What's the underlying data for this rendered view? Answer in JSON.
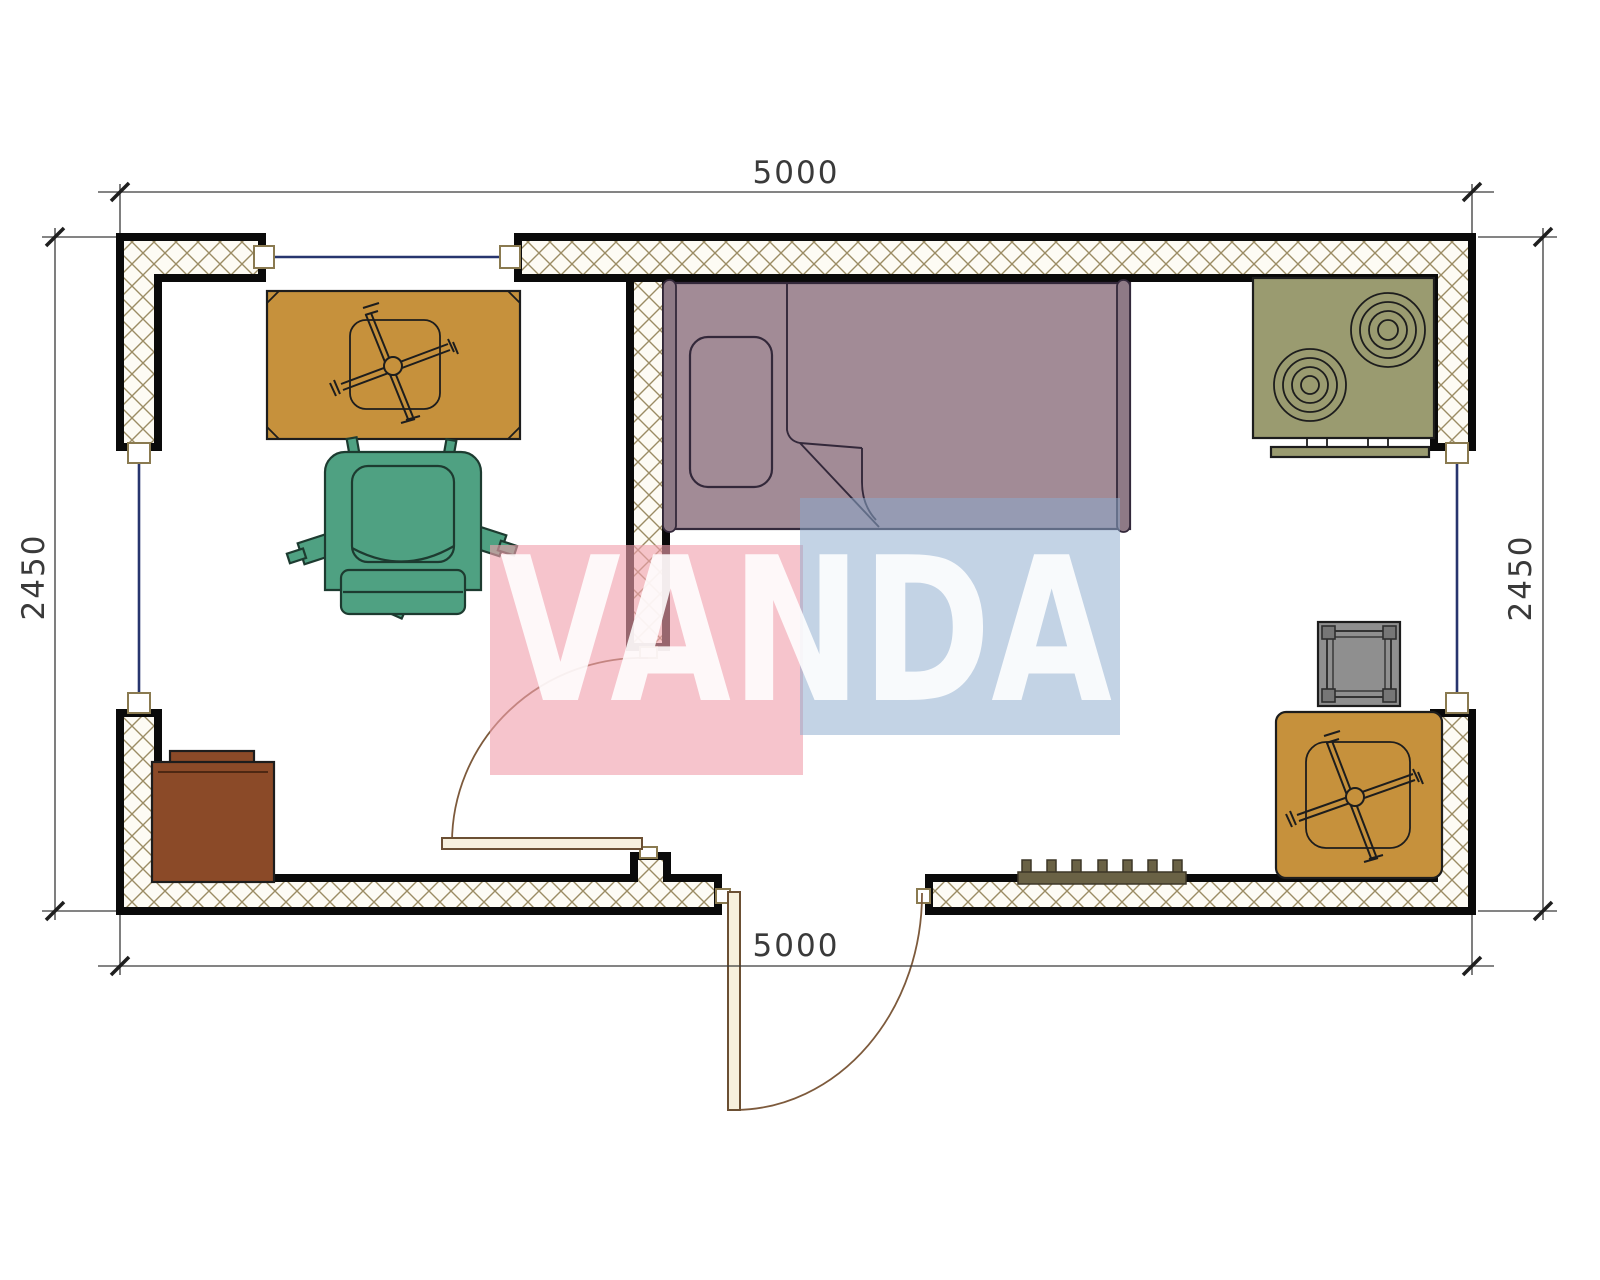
{
  "drawing": {
    "type": "floor-plan",
    "units": "mm"
  },
  "dimensions": {
    "top": "5000",
    "bottom": "5000",
    "left": "2450",
    "right": "2450"
  },
  "watermark": {
    "text": "VANDA",
    "pink_fill": "rgba(240,160,172,0.62)",
    "blue_fill": "rgba(140,170,205,0.52)",
    "text_fill": "rgba(255,255,255,0.88)"
  },
  "palette": {
    "wall_outline": "#0a0a0a",
    "hatch_line": "#9b8c64",
    "hatch_bg": "#fdfbf4",
    "window_line": "#27356e",
    "door_line": "#7d5a3c",
    "door_leaf": "#f7f0dd",
    "dimension_text": "#3a3a3a",
    "desk": "#c6913c",
    "side_table": "#c6913c",
    "armchair": "#4fa182",
    "bed": "#a28b96",
    "bed_post": "#8e7a86",
    "stove": "#9a9b70",
    "gray_table": "#8f8f8f",
    "gray_table_leg": "#767676",
    "cabinet": "#8b4a28",
    "radiator": "#6a6245"
  }
}
